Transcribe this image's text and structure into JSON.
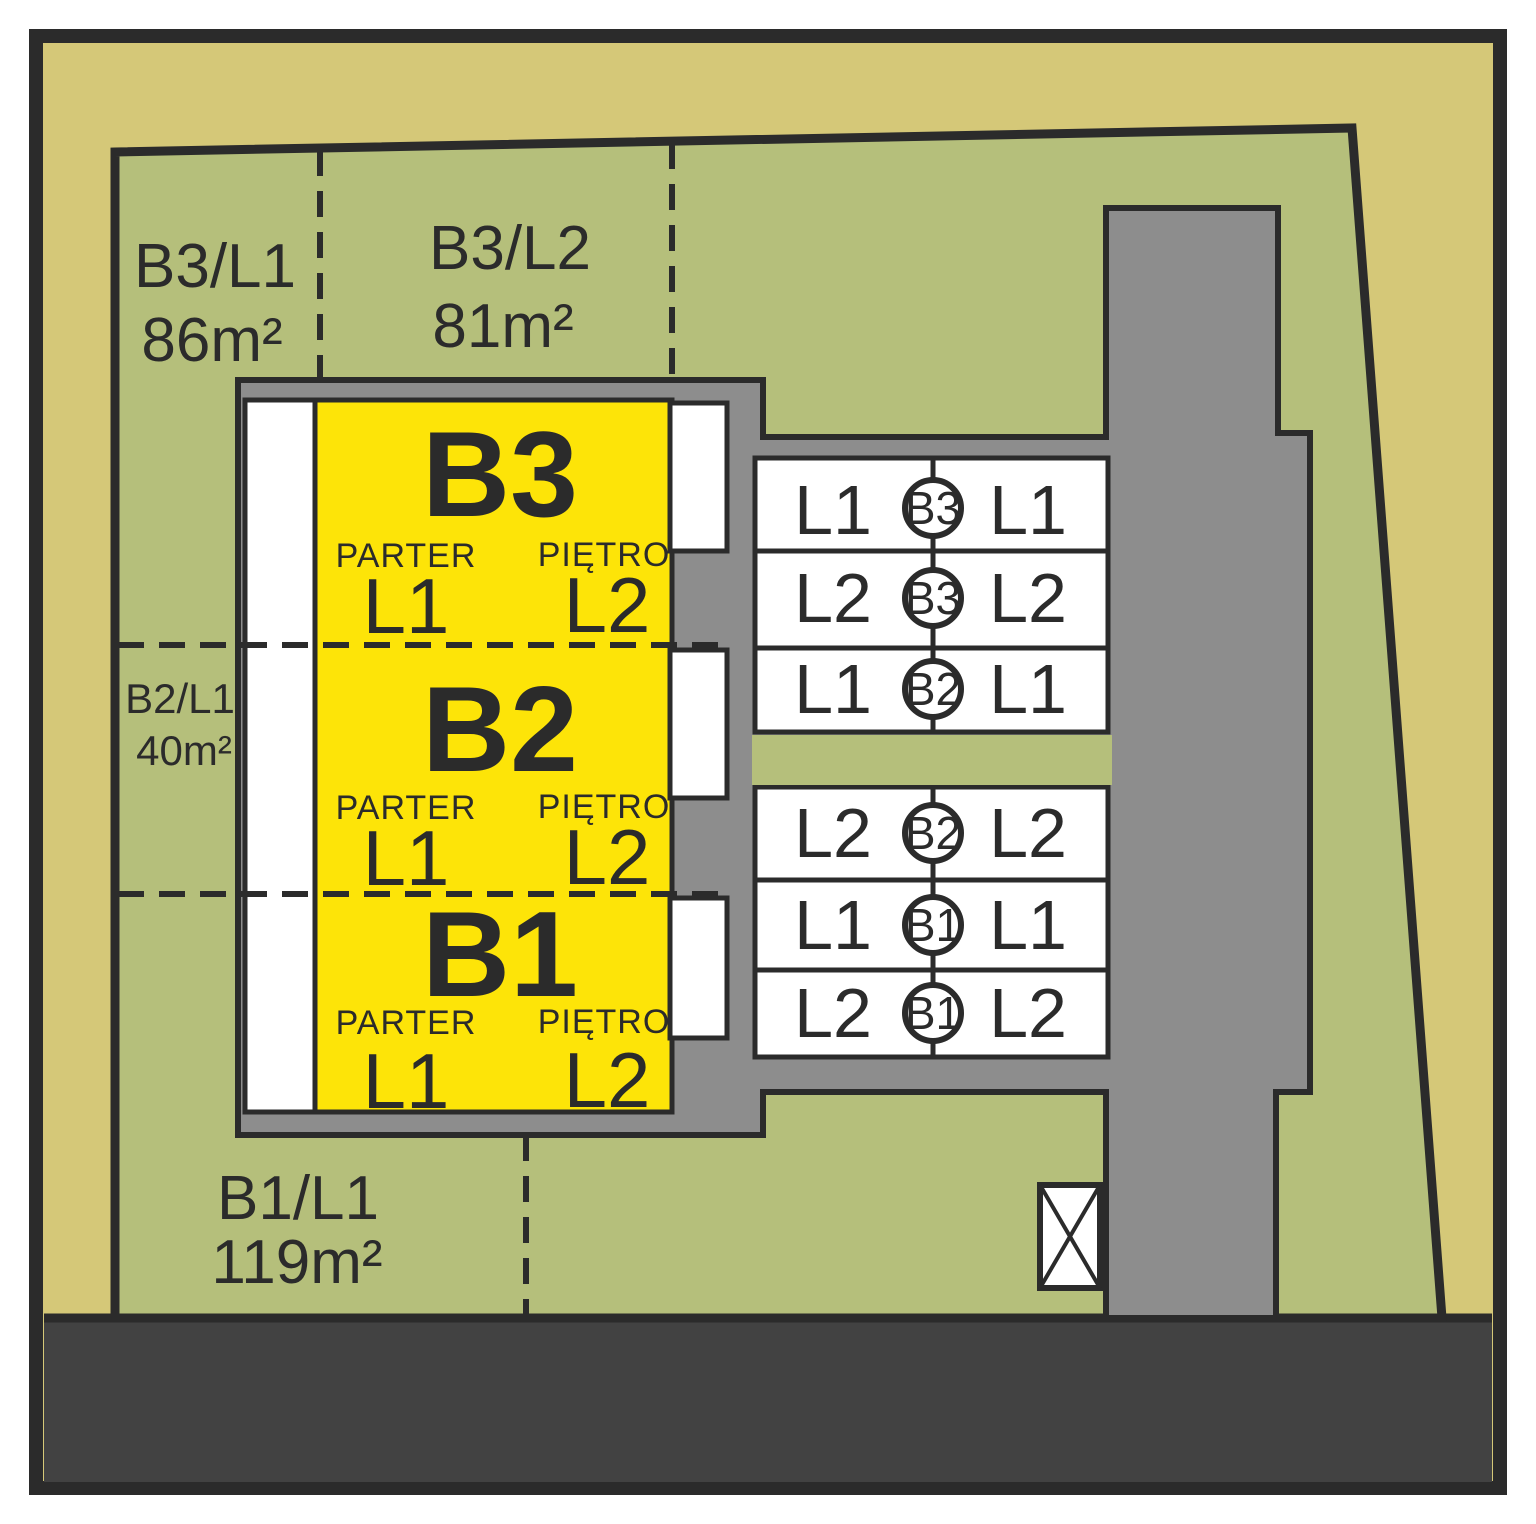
{
  "plan_title": "site-plan",
  "colors": {
    "ground": "#d5c878",
    "grass": "#b5bf7b",
    "paving": "#8d8d8d",
    "road": "#424242",
    "unit": "#fde408",
    "cell": "#ffffff",
    "ink": "#2b2b2b"
  },
  "areas": [
    {
      "id": "b3l1",
      "name": "B3/L1",
      "size": "86m²"
    },
    {
      "id": "b3l2",
      "name": "B3/L2",
      "size": "81m²"
    },
    {
      "id": "b2l1",
      "name": "B2/L1",
      "size": "40m²"
    },
    {
      "id": "b1l1",
      "name": "B1/L1",
      "size": "119m²"
    }
  ],
  "building": {
    "segments": [
      {
        "id": "B3",
        "ground_label": "PARTER",
        "ground_unit": "L1",
        "upper_label": "PIĘTRO",
        "upper_unit": "L2"
      },
      {
        "id": "B2",
        "ground_label": "PARTER",
        "ground_unit": "L1",
        "upper_label": "PIĘTRO",
        "upper_unit": "L2"
      },
      {
        "id": "B1",
        "ground_label": "PARTER",
        "ground_unit": "L1",
        "upper_label": "PIĘTRO",
        "upper_unit": "L2"
      }
    ]
  },
  "parking": {
    "rows": [
      {
        "left": "L1",
        "building": "B3",
        "right": "L1"
      },
      {
        "left": "L2",
        "building": "B3",
        "right": "L2"
      },
      {
        "left": "L1",
        "building": "B2",
        "right": "L1"
      },
      {
        "left": "L2",
        "building": "B2",
        "right": "L2"
      },
      {
        "left": "L1",
        "building": "B1",
        "right": "L1"
      },
      {
        "left": "L2",
        "building": "B1",
        "right": "L2"
      }
    ]
  }
}
